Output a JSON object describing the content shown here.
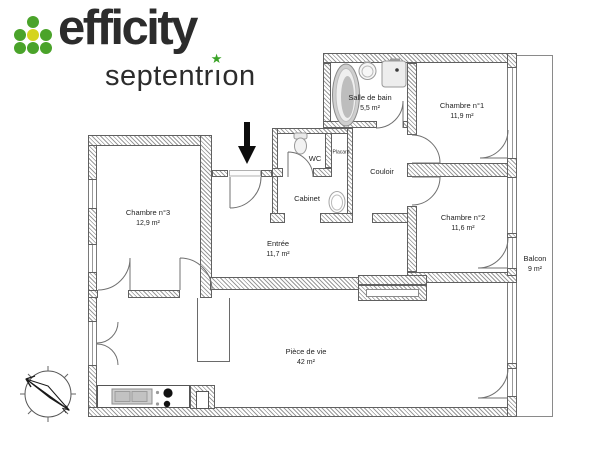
{
  "logo": {
    "brand": "efficity",
    "sub": "septentrion",
    "sub_pre": "septentr",
    "sub_i": "ı",
    "sub_post": "on",
    "star": "★",
    "colors": {
      "dot_green": "#4aa32a",
      "dot_yellow": "#d5d41f",
      "star_green": "#3aa327",
      "text": "#2c2c2c"
    }
  },
  "rooms": {
    "salle_de_bain": {
      "name": "Salle de bain",
      "area": "5,5 m²"
    },
    "chambre1": {
      "name": "Chambre n°1",
      "area": "11,9 m²"
    },
    "chambre2": {
      "name": "Chambre n°2",
      "area": "11,6 m²"
    },
    "chambre3": {
      "name": "Chambre n°3",
      "area": "12,9 m²"
    },
    "entree": {
      "name": "Entrée",
      "area": "11,7 m²"
    },
    "piece_de_vie": {
      "name": "Pièce de vie",
      "area": "42 m²"
    },
    "balcon": {
      "name": "Balcon",
      "area": "9 m²"
    },
    "couloir": {
      "name": "Couloir"
    },
    "wc": {
      "name": "WC"
    },
    "placard": {
      "name": "Placard"
    },
    "cabinet": {
      "name": "Cabinet"
    }
  },
  "compass": {
    "north_label": "N"
  },
  "icons": {
    "bathtub": "bathtub-icon",
    "washbasin": "washbasin-icon",
    "shower": "shower-icon",
    "toilet": "toilet-icon",
    "cabinet_sink": "sink-icon",
    "kitchen_sink": "kitchen-sink-icon",
    "cooktop": "cooktop-icon",
    "compass_rose": "compass-rose-icon",
    "entrance_arrow": "entrance-arrow-icon"
  }
}
